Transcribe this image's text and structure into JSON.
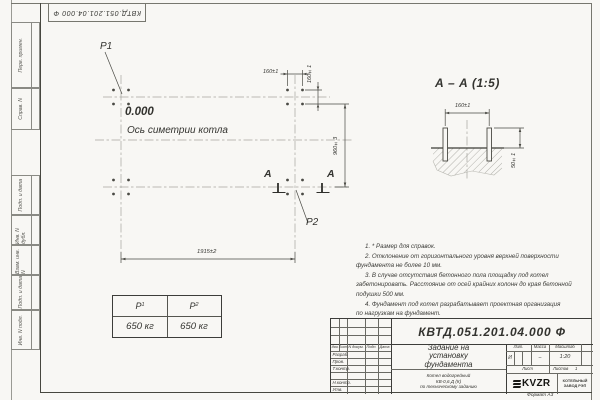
{
  "colors": {
    "paper": "#f8f7f4",
    "ink": "#3d3d3a"
  },
  "doc_number": "КВТД.051.201.04.000 Ф",
  "sidebar": {
    "labels": [
      "Перв. примен.",
      "Справ. N",
      "Подп. и дата",
      "Инв. N дубл.",
      "Взам. инв. N",
      "Подп. и дата",
      "Инв. N подл."
    ]
  },
  "plan": {
    "p1": "P1",
    "p2": "P2",
    "level": "0.000",
    "axis_label": "Ось симетрии котла",
    "dim_top": "160±1",
    "dim_side": "160±1",
    "dim_height": "960±3",
    "dim_width": "1915±2",
    "section_letter": "А"
  },
  "section": {
    "title": "А – А  (1:5)",
    "dim_bolts": "160±1",
    "dim_protrusion": "50±1"
  },
  "load_table": {
    "p1": "P",
    "p1_sub": "1",
    "p2": "P",
    "p2_sub": "2",
    "values": [
      "650 кг",
      "650 кг"
    ]
  },
  "notes": {
    "lines": [
      "1. * Размер для справок.",
      "2. Отклонение от горизонтального уровня верхней поверхности",
      "фундамента не более 10 мм.",
      "3. В случае отсутствия бетонного пола площадку под котел",
      "забетонировать. Расстояние от осей крайних колонн до края бетонной",
      "подушки 500 мм.",
      "4. Фундамент под котел разрабатывает проектная организация",
      "по нагрузкам на фундамент."
    ]
  },
  "titleblock": {
    "columns": [
      "Изм.",
      "Лист",
      "N докум.",
      "Подп.",
      "Дата"
    ],
    "sign_rows": [
      "Разраб.",
      "Пров.",
      "Т.контр.",
      "Н.контр.",
      "Утв."
    ],
    "title_lines": [
      "Задание на",
      "установку",
      "фундамента"
    ],
    "subtitle_lines": [
      "Котел водогрейный",
      "КВ-0,6 Д (К)",
      "по техническому заданию"
    ],
    "lit_label": "Лит.",
    "mass_label": "Масса",
    "scale_label": "Масштаб",
    "lit_value": "И",
    "mass_value": "–",
    "scale_value": "1:20",
    "sheet_label": "Лист",
    "sheets_label": "Листов",
    "sheets_value": "1",
    "logo_text": "KVZR",
    "company_lines": [
      "КОТЕЛЬНЫЙ",
      "ЗАВОД РЭП"
    ],
    "format_note": "Формат А3"
  }
}
